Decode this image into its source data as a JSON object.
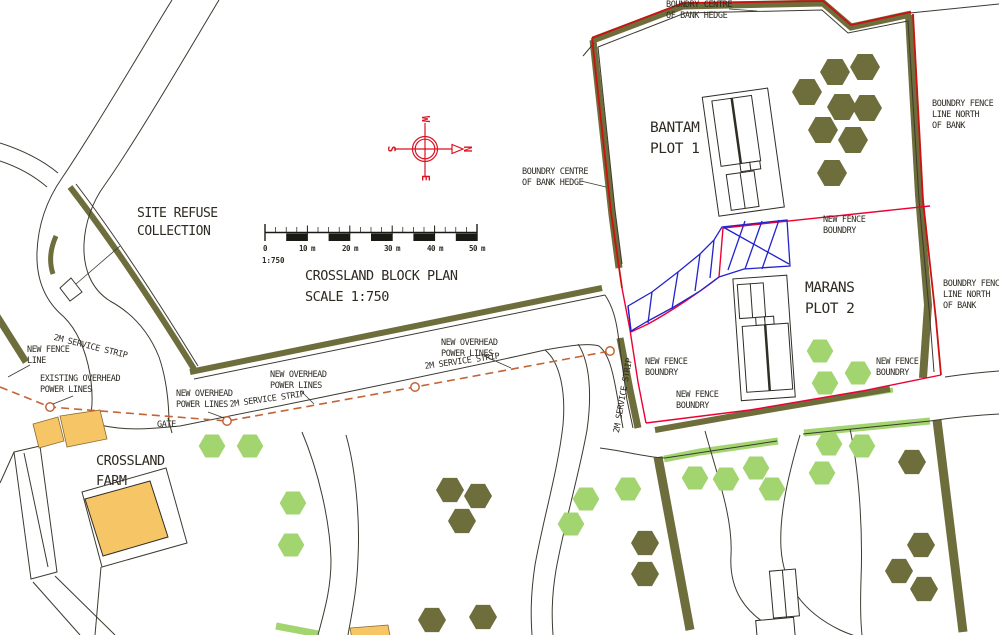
{
  "title_block": {
    "title": "CROSSLAND BLOCK PLAN",
    "scale": "SCALE 1:750"
  },
  "scale_bar": {
    "ticks": [
      "0",
      "10 m",
      "20 m",
      "30 m",
      "40 m",
      "50 m"
    ],
    "ratio": "1:750"
  },
  "compass": {
    "top": "W",
    "right": "N",
    "bottom": "E",
    "left": "S"
  },
  "labels": {
    "site_refuse": "SITE REFUSE\nCOLLECTION",
    "bantam": "BANTAM\nPLOT 1",
    "marans": "MARANS\nPLOT 2",
    "farm": "CROSSLAND\nFARM",
    "gate": "GATE",
    "boundry_centre": "BOUNDRY CENTRE\nOF BANK HEDGE",
    "boundry_fence_north": "BOUNDRY FENCE\nLINE NORTH\nOF BANK",
    "new_fence_boundry": "NEW FENCE\nBOUNDRY",
    "new_fence_line": "NEW FENCE\nLINE",
    "existing_overhead": "EXISTING OVERHEAD\nPOWER LINES",
    "new_overhead": "NEW OVERHEAD\nPOWER LINES",
    "service_strip": "2M SERVICE STRIP"
  },
  "colors": {
    "hedge_olive": "#6e6d3c",
    "tree_light_green": "#a2d470",
    "boundary_red": "#cc1111",
    "fence_red": "#ee0033",
    "hatch_blue": "#2323cc",
    "power_line_orange": "#c26437",
    "building_yellow": "#f5c566",
    "compass_red": "#dd1122",
    "linework": "#3c3a30"
  }
}
